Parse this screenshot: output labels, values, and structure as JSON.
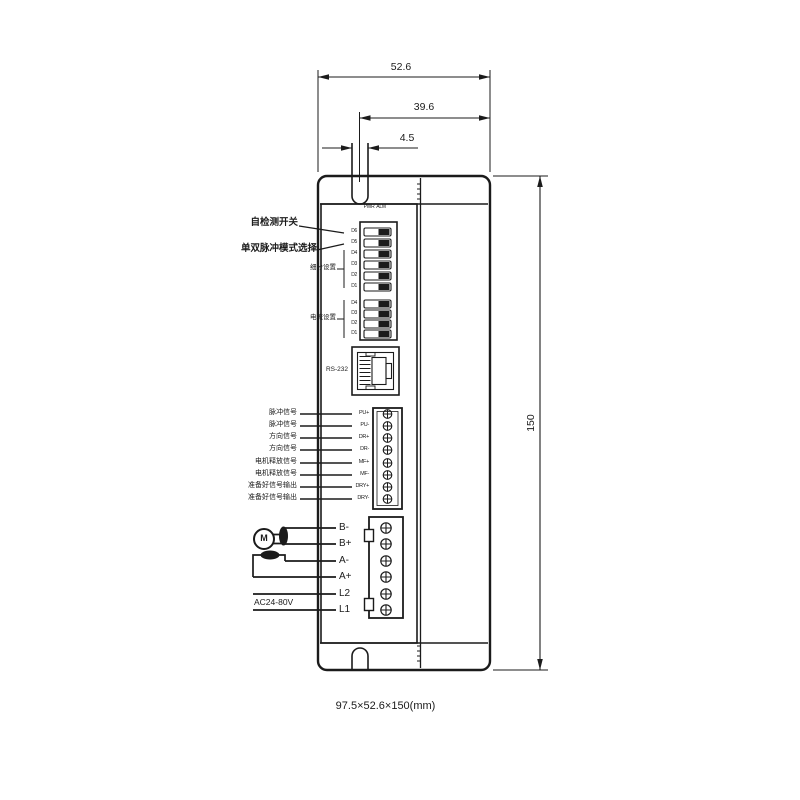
{
  "colors": {
    "line": "#1b1b1b",
    "background": "#ffffff"
  },
  "dimensions": {
    "width": "52.6",
    "inner_width": "39.6",
    "slot_width": "4.5",
    "height": "150",
    "overall": "97.5×52.6×150(mm)"
  },
  "leds": {
    "pwr": "PWR",
    "alm": "ALM"
  },
  "labels": {
    "self_test": "自检测开关",
    "pulse_mode": "单双脉冲模式选择",
    "microstep": "细分设置",
    "current": "电流设置",
    "rs232": "RS-232",
    "ac_input": "AC24-80V",
    "motor": "M"
  },
  "dip": {
    "bank1_pins": [
      "D6",
      "D5",
      "D4",
      "D3",
      "D2",
      "D1"
    ],
    "bank2_pins": [
      "D4",
      "D3",
      "D2",
      "D1"
    ]
  },
  "signal_rows": [
    {
      "cn": "脉冲信号",
      "pin": "PU+"
    },
    {
      "cn": "脉冲信号",
      "pin": "PU-"
    },
    {
      "cn": "方向信号",
      "pin": "DR+"
    },
    {
      "cn": "方向信号",
      "pin": "DR-"
    },
    {
      "cn": "电机释放信号",
      "pin": "MF+"
    },
    {
      "cn": "电机释放信号",
      "pin": "MF-"
    },
    {
      "cn": "准备好信号输出",
      "pin": "DRY+"
    },
    {
      "cn": "准备好信号输出",
      "pin": "DRY-"
    }
  ],
  "power_pins": [
    "B-",
    "B+",
    "A-",
    "A+",
    "L2",
    "L1"
  ]
}
